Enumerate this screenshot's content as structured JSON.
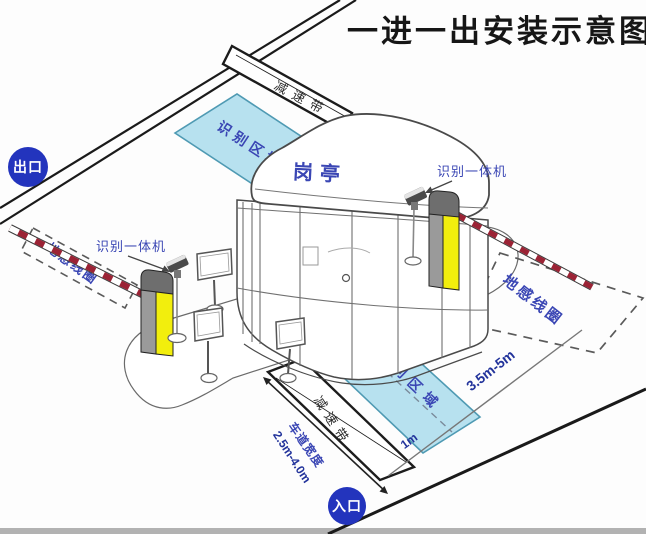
{
  "title": "一进一出安装示意图",
  "badges": {
    "exit": "出口",
    "entry": "入口"
  },
  "booth": {
    "label": "岗亭"
  },
  "areas": {
    "recognition": "识别区域",
    "ground_loop": "地感线圈"
  },
  "equipment": {
    "reader": "识别一体机",
    "speed_bump": "减速带"
  },
  "dimensions": {
    "lane_width_label": "车道宽度",
    "lane_width_value": "2.5m-4.0m",
    "loop_distance": "3.5m-5m",
    "area_offset": "1m"
  },
  "colors": {
    "recognition_fill": "#b7e1ef",
    "recognition_stroke": "#4f9ab3",
    "label_blue": "#3a46b4",
    "dimension_navy": "#22339b",
    "badge_blue": "#2334bd",
    "arm_red": "#9b2335",
    "machine_yellow": "#f2ee0d",
    "machine_gray": "#9a9a9a",
    "title_color": "#161616"
  }
}
